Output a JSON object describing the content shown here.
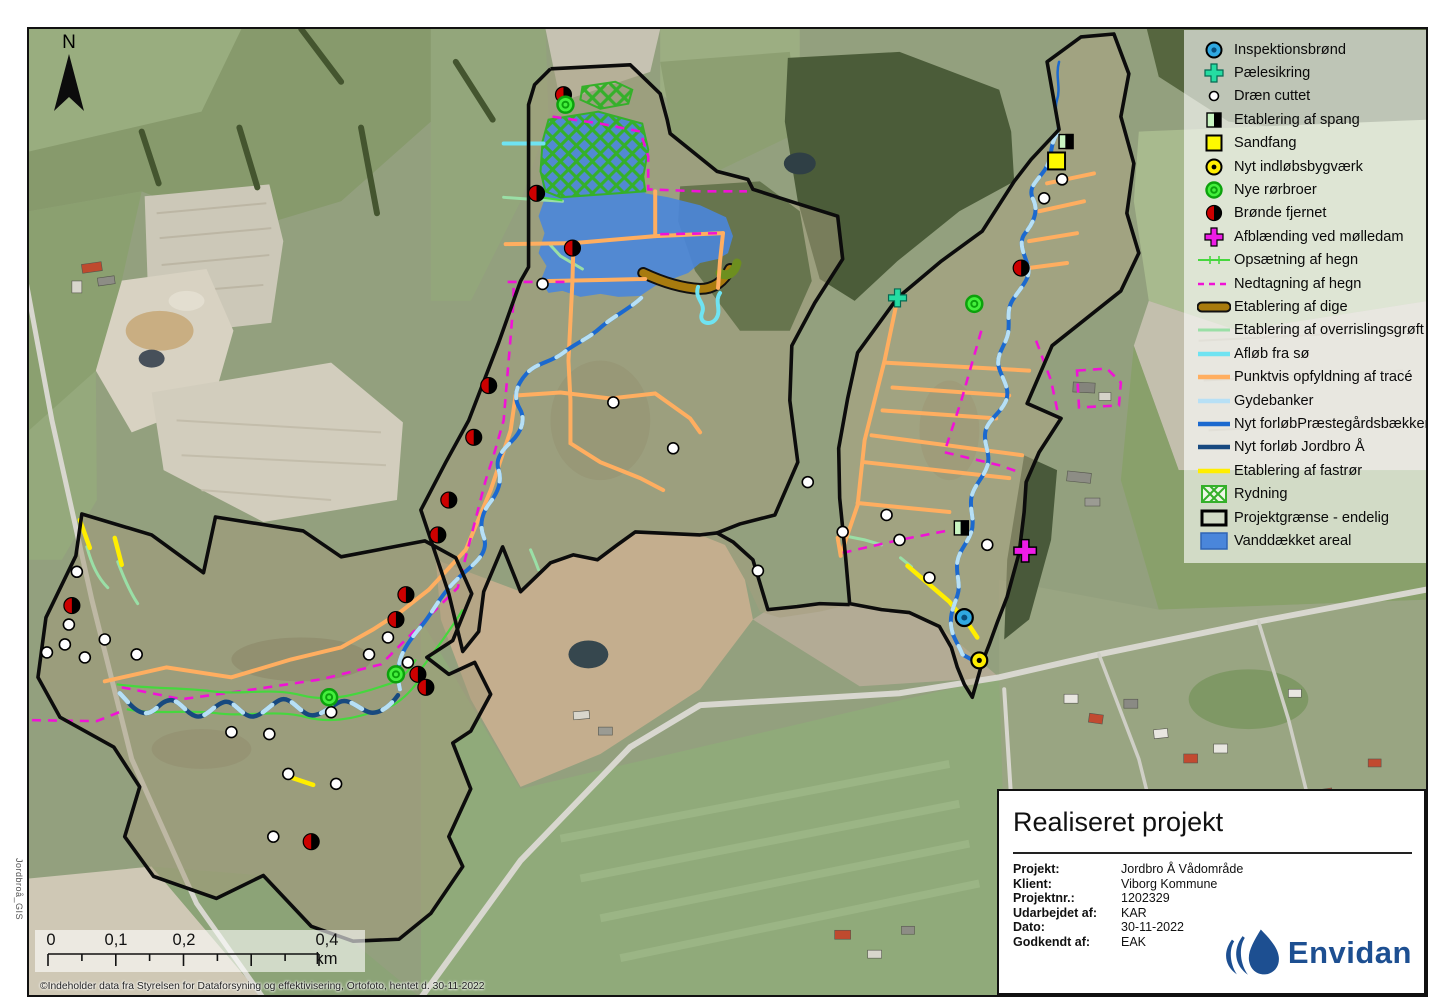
{
  "map": {
    "north_label": "N",
    "side_label": "Jordbroå_GIS",
    "copyright": "©Indeholder data fra Styrelsen for Dataforsyning og effektivisering, Ortofoto, hentet d. 30-11-2022",
    "scalebar": {
      "labels": [
        "0",
        "0,1",
        "0,2",
        "0,4 km"
      ]
    }
  },
  "legend": {
    "items": [
      {
        "label": "Inspektionsbrønd"
      },
      {
        "label": "Pælesikring"
      },
      {
        "label": "Dræn cuttet"
      },
      {
        "label": "Etablering af spang"
      },
      {
        "label": "Sandfang"
      },
      {
        "label": "Nyt indløbsbygværk"
      },
      {
        "label": "Nye rørbroer"
      },
      {
        "label": "Brønde fjernet"
      },
      {
        "label": "Afblænding ved mølledam"
      },
      {
        "label": "Opsætning af hegn"
      },
      {
        "label": "Nedtagning af hegn"
      },
      {
        "label": "Etablering af dige"
      },
      {
        "label": "Etablering af overrislingsgrøft"
      },
      {
        "label": "Afløb fra sø"
      },
      {
        "label": "Punktvis opfyldning af tracé"
      },
      {
        "label": "Gydebanker"
      },
      {
        "label": "Nyt forløbPræstegårdsbækken"
      },
      {
        "label": "Nyt forløb Jordbro Å"
      },
      {
        "label": "Etablering af fastrør"
      },
      {
        "label": "Rydning"
      },
      {
        "label": "Projektgrænse - endelig"
      },
      {
        "label": "Vanddækket areal"
      }
    ]
  },
  "title_block": {
    "title": "Realiseret projekt",
    "rows": [
      {
        "label": "Projekt:",
        "value": "Jordbro Å Vådområde"
      },
      {
        "label": "Klient:",
        "value": "Viborg Kommune"
      },
      {
        "label": "Projektnr.:",
        "value": "1202329"
      },
      {
        "label": "Udarbejdet af:",
        "value": "KAR"
      },
      {
        "label": "Dato:",
        "value": "30-11-2022"
      },
      {
        "label": "Godkendt af:",
        "value": "EAK"
      }
    ],
    "logo_text": "Envidan"
  },
  "colors": {
    "boundary": "#0c0c0c",
    "water_area": "#4a86db",
    "stream_main": "#1b69cf",
    "stream_jordbro": "#17497f",
    "gydebanker": "#b7e0f5",
    "aflob": "#6fe3f2",
    "orange": "#ffae60",
    "hegn_op": "#46d73e",
    "hegn_ned": "#f012d6",
    "dige": "#a87b0e",
    "dige_end": "#6d8f1f",
    "overrisling": "#9adfa6",
    "fastror": "#ffee00",
    "rydning": "#35b02a",
    "bronde_red": "#cc0000",
    "paelesikring": "#25dca2",
    "afblanding": "#ee1ce6",
    "inspektion_fill": "#2fa8e1",
    "inspektion_dot": "#0a4f7d",
    "indlob_fill": "#ffee00",
    "rorbro_fill": "#44ef3c",
    "rorbro_ring": "#0ca10c",
    "sandfang": "#fdf900",
    "spang_green": "#c9f5c2",
    "logo_blue": "#1d4f91"
  }
}
